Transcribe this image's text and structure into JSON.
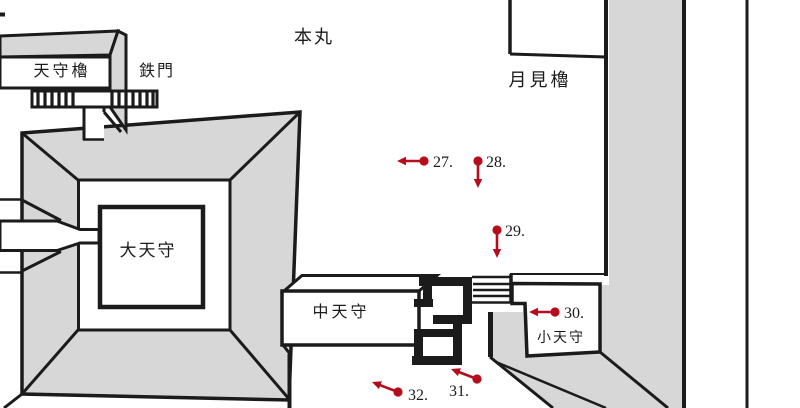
{
  "map": {
    "area_label": "本丸",
    "buildings": {
      "tenshu_yagura": "天守櫓",
      "tetsumon": "鉄門",
      "tsukimi_yagura": "月見櫓",
      "daitenshu": "大天守",
      "chutenshu": "中天守",
      "kotenshu": "小天守"
    }
  },
  "markers": [
    {
      "id": "27",
      "label": "27.",
      "dot": {
        "x": 424,
        "y": 161
      },
      "tip": {
        "x": 397,
        "y": 161
      },
      "text": {
        "x": 433,
        "y": 167
      }
    },
    {
      "id": "28",
      "label": "28.",
      "dot": {
        "x": 478,
        "y": 161
      },
      "tip": {
        "x": 478,
        "y": 188
      },
      "text": {
        "x": 486,
        "y": 167
      }
    },
    {
      "id": "29",
      "label": "29.",
      "dot": {
        "x": 497,
        "y": 230
      },
      "tip": {
        "x": 497,
        "y": 258
      },
      "text": {
        "x": 505,
        "y": 236
      }
    },
    {
      "id": "30",
      "label": "30.",
      "dot": {
        "x": 555,
        "y": 312
      },
      "tip": {
        "x": 529,
        "y": 312
      },
      "text": {
        "x": 564,
        "y": 318
      }
    },
    {
      "id": "31",
      "label": "31.",
      "dot": {
        "x": 477,
        "y": 379
      },
      "tip": {
        "x": 451,
        "y": 369
      },
      "text": {
        "x": 449,
        "y": 396
      }
    },
    {
      "id": "32",
      "label": "32.",
      "dot": {
        "x": 398,
        "y": 392
      },
      "tip": {
        "x": 372,
        "y": 382
      },
      "text": {
        "x": 408,
        "y": 400
      }
    }
  ],
  "colors": {
    "marker": "#b60d1c",
    "line": "#1b1b1b",
    "roof": "#d7d7d7",
    "background": "#ffffff"
  }
}
